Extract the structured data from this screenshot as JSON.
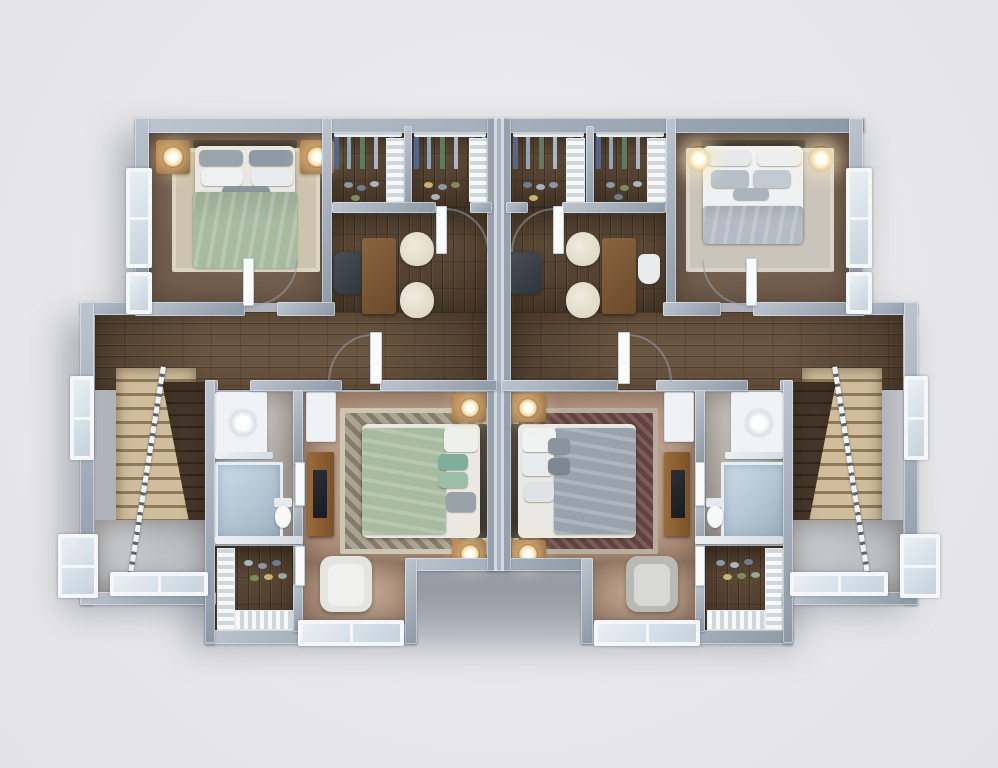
{
  "meta": {
    "title": "3D top-down floor plan rendering of a mirrored two-unit (duplex) upper floor",
    "view": "top-down-3d",
    "units_count": 2,
    "visible_text": "none"
  },
  "palette": {
    "background": "#e9e9eb",
    "wall": "#a2adb9",
    "wall_highlight": "#d3d9df",
    "wood_floor_dark": "#5c4936",
    "wood_floor_hall": "#6a5540",
    "carpet_bedroom_dark": "#746050",
    "carpet_master_tan": "#b2937e",
    "stair_landing_gray": "#bdc1c5",
    "bath_floor": "#b3aea6",
    "steps_beige": "#cfbd9c",
    "duvet_sage_green": "#a7bba1",
    "duvet_gray": "#9aa3ad",
    "blanket_gray": "#b3bcc4",
    "rug_left_master": "#aca390",
    "rug_right_master_maroon": "#63423f",
    "rug_light": "#ccc4ae",
    "nightstand_wood": "#a06b3a",
    "desk_wood": "#7b5a3c",
    "office_chair_dark": "#3d434b",
    "chair_cream": "#e9e3d5",
    "lamp_glow": "#f2d9a2",
    "white_trim": "#f4f6f8"
  },
  "units": [
    {
      "id": "left-unit",
      "rooms": [
        {
          "id": 0,
          "label": "Bedroom (sage bed)"
        },
        {
          "id": 1,
          "label": "Walk-in closet A"
        },
        {
          "id": 2,
          "label": "Walk-in closet B"
        },
        {
          "id": 3,
          "label": "Office / loft"
        },
        {
          "id": 4,
          "label": "Hallway"
        },
        {
          "id": 5,
          "label": "Stairwell"
        },
        {
          "id": 6,
          "label": "Bathroom"
        },
        {
          "id": 7,
          "label": "Shoe closet"
        },
        {
          "id": 8,
          "label": "Master bedroom (sage bed)"
        }
      ],
      "furniture": [
        "queen bed",
        "two nightstands with lamps",
        "area rugs",
        "desk",
        "office chair",
        "two cream chairs",
        "hanging clothes",
        "shoe shelves",
        "vanity sink",
        "shower",
        "toilet",
        "dresser with TV",
        "armchair",
        "staircase with railing"
      ]
    },
    {
      "id": "right-unit",
      "rooms": [
        {
          "id": 0,
          "label": "Bedroom (white bed)"
        },
        {
          "id": 1,
          "label": "Walk-in closet C"
        },
        {
          "id": 2,
          "label": "Walk-in closet D"
        },
        {
          "id": 3,
          "label": "Office / loft"
        },
        {
          "id": 4,
          "label": "Hallway"
        },
        {
          "id": 5,
          "label": "Stairwell"
        },
        {
          "id": 6,
          "label": "Bathroom"
        },
        {
          "id": 7,
          "label": "Shoe closet"
        },
        {
          "id": 8,
          "label": "Master bedroom (gray bed)"
        }
      ],
      "furniture": [
        "queen bed",
        "wall lamps",
        "area rugs",
        "desk",
        "office chair",
        "two cream chairs",
        "task chair",
        "hanging clothes",
        "shoe shelves",
        "vanity sink",
        "shower",
        "toilet",
        "dresser",
        "armchair",
        "staircase with railing"
      ]
    }
  ]
}
